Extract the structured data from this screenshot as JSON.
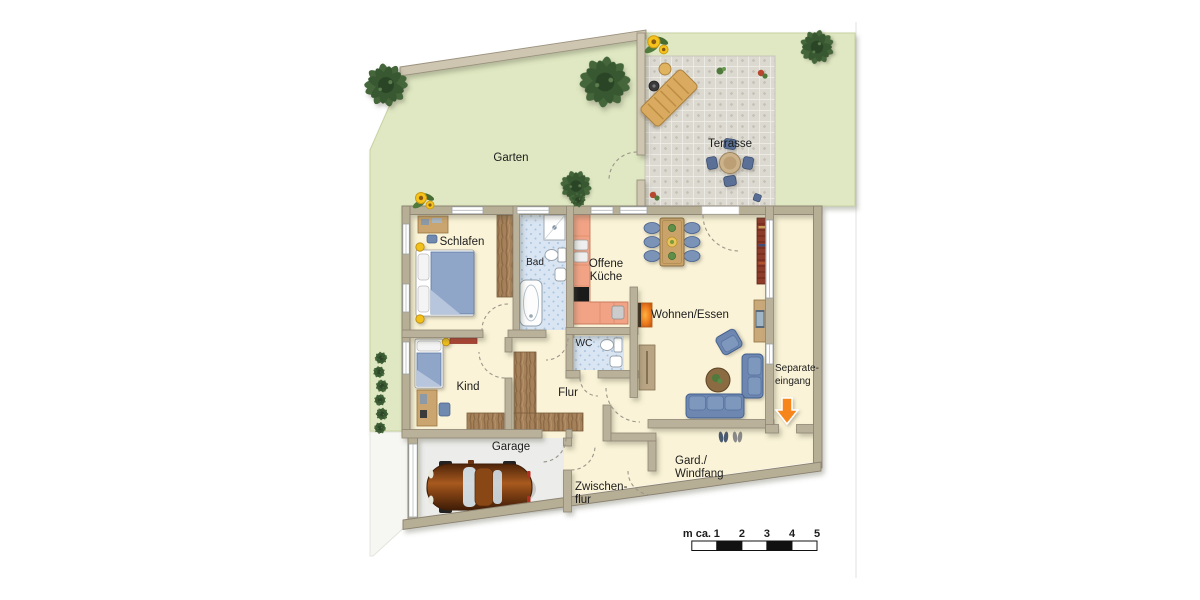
{
  "plan": {
    "outdoor_labels": {
      "garten": "Garten",
      "terrasse": "Terrasse"
    },
    "room_labels": {
      "schlafen": "Schlafen",
      "bad": "Bad",
      "offene_kueche_line1": "Offene",
      "offene_kueche_line2": "Küche",
      "wohnen_essen": "Wohnen/Essen",
      "kind": "Kind",
      "flur": "Flur",
      "wc": "WC",
      "garage": "Garage",
      "zwischenflur_line1": "Zwischen-",
      "zwischenflur_line2": "flur",
      "gard_windfang_line1": "Gard./",
      "gard_windfang_line2": "Windfang",
      "separate_eingang_line1": "Separate-",
      "separate_eingang_line2": "eingang"
    },
    "scale_bar": {
      "unit_label": "m ca.",
      "ticks": [
        "1",
        "2",
        "3",
        "4",
        "5"
      ],
      "segment_meters": 1,
      "total_meters": 5
    },
    "colors": {
      "garden_green": "#dfe8c2",
      "terrace_gray": "#dcd9d1",
      "floor_cream": "#faf3d7",
      "wall_tan": "#b7ae96",
      "tile_blue": "#d9e5f2",
      "kitchen_salmon": "#f2a386",
      "furniture_blue": "#7089ae",
      "wood_brown": "#a5815a",
      "entrance_arrow_orange": "#f6861f",
      "bookshelf_red": "#8d3b2a",
      "car_brown": "#8a4716"
    }
  }
}
